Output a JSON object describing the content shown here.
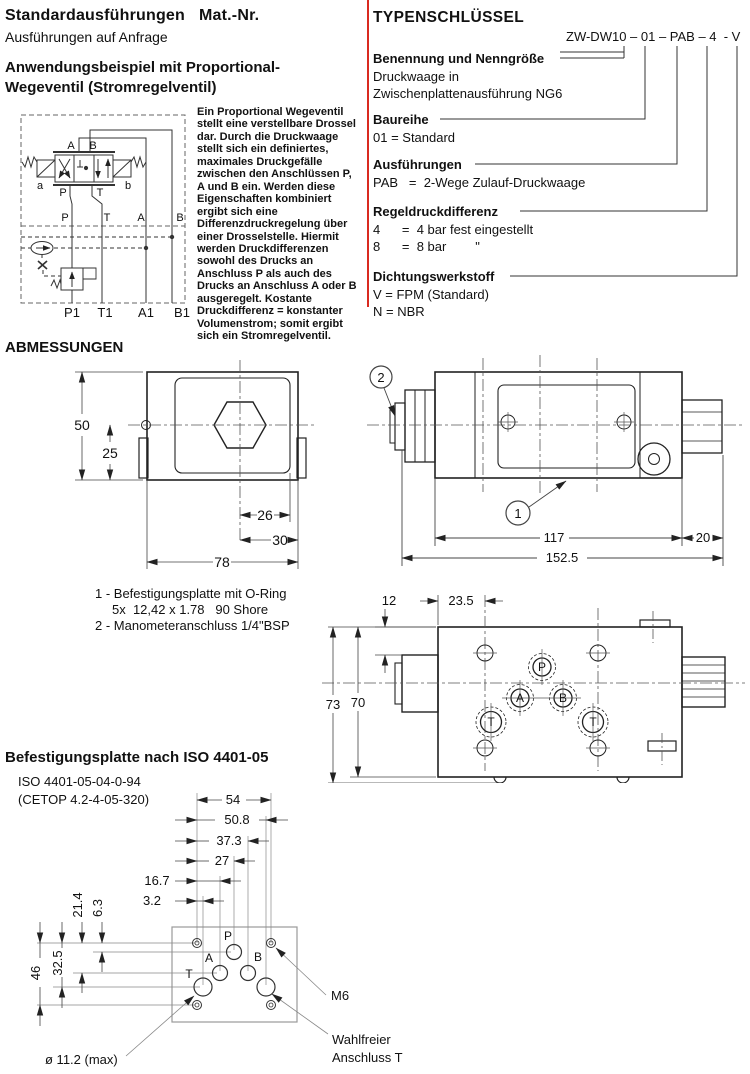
{
  "page": {
    "accent_red": "#d92a20"
  },
  "top_left": {
    "heading_bold": "Standardausführungen",
    "heading_matnr": "Mat.-Nr.",
    "subheading": "Ausführungen auf Anfrage",
    "example_heading": "Anwendungsbeispiel mit Proportional-\nWegeventil (Stromregelventil)",
    "description": "Ein Proportional Wegeventil\nstellt eine verstellbare Drossel\ndar. Durch die Druckwaage\nstellt sich ein definiertes,\nmaximales Druckgefälle\nzwischen den Anschlüssen P,\nA und B ein. Werden diese\nEigenschaften kombiniert\nergibt sich eine\nDifferenzdruckregelung über\neiner Drosselstelle. Hiermit\nwerden Druckdifferenzen\nsowohl des Drucks an\nAnschluss P als auch des\nDrucks an Anschluss A oder B\nausgeregelt. Kostante\nDruckdifferenz = konstanter\nVolumenstrom; somit ergibt\nsich ein Stromregelventil."
  },
  "circuit": {
    "valve_top_a": "A",
    "valve_top_b": "B",
    "valve_bottom_p": "P",
    "valve_bottom_t": "T",
    "sol_a": "a",
    "sol_b": "b",
    "mid_ports": [
      "P",
      "T",
      "A",
      "B"
    ],
    "bottom_ports": [
      "P1",
      "T1",
      "A1",
      "B1"
    ]
  },
  "typenschluessel": {
    "heading": "TYPENSCHLÜSSEL",
    "code": "ZW-DW10 – 01 – PAB – 4  - V",
    "sections": [
      {
        "label": "Benennung und Nenngröße",
        "line1": "Druckwaage in",
        "line2": "Zwischenplattenausführung NG6"
      },
      {
        "label": "Baureihe",
        "line1": "01 = Standard",
        "line2": ""
      },
      {
        "label": "Ausführungen",
        "line1": "PAB   =  2-Wege Zulauf-Druckwaage",
        "line2": ""
      },
      {
        "label": "Regeldruckdifferenz",
        "line1": "4      =  4 bar fest eingestellt",
        "line2": "8      =  8 bar        \""
      },
      {
        "label": "Dichtungswerkstoff",
        "line1": "V = FPM (Standard)",
        "line2": "N = NBR"
      }
    ]
  },
  "abmessungen": {
    "heading": "ABMESSUNGEN",
    "front_view": {
      "d_height": "50",
      "d_half": "25",
      "d_26": "26",
      "d_30": "30",
      "d_width": "78"
    },
    "side_view": {
      "balloon_1": "1",
      "balloon_2": "2",
      "d_117": "117",
      "d_20": "20",
      "d_total": "152.5"
    },
    "notes": {
      "line1": "1 - Befestigungsplatte mit O-Ring",
      "line2": "5x  12,42 x 1.78   90 Shore",
      "line3": "2 - Manometeranschluss 1/4\"BSP"
    },
    "top_view": {
      "d_12": "12",
      "d_23_5": "23.5",
      "d_73": "73",
      "d_70": "70",
      "port_p": "P",
      "port_a": "A",
      "port_b": "B",
      "port_t1": "T",
      "port_t2": "T"
    }
  },
  "mounting_plate": {
    "heading": "Befestigungsplatte nach ISO 4401-05",
    "iso_code": "ISO 4401-05-04-0-94",
    "cetop_code": "(CETOP 4.2-4-05-320)",
    "dims_horizontal": [
      "54",
      "50.8",
      "37.3",
      "27",
      "16.7",
      "3.2"
    ],
    "dims_vertical": [
      "21.4",
      "6.3",
      "32.5",
      "46"
    ],
    "port_p": "P",
    "port_a": "A",
    "port_b": "B",
    "port_t": "T",
    "label_m6": "M6",
    "label_optional_line1": "Wahlfreier",
    "label_optional_line2": "Anschluss T",
    "label_diameter": "ø 11.2 (max)"
  }
}
